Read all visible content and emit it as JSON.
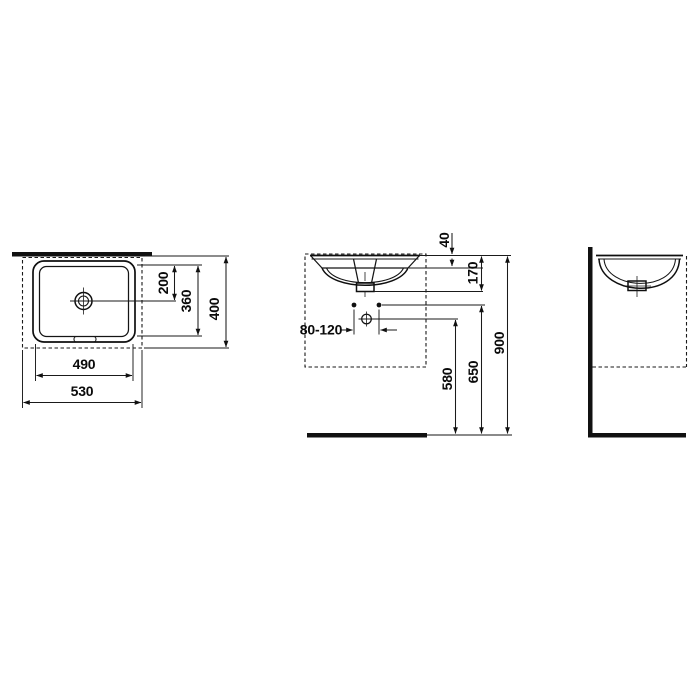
{
  "drawing": {
    "subject": "undermount-washbasin-installation-diagram",
    "line_color": "#1a1a1a",
    "background": "#ffffff"
  },
  "views": {
    "top": {
      "label": "top-view",
      "dims": {
        "d200": "200",
        "d360": "360",
        "d400": "400",
        "d490": "490",
        "d530": "530"
      }
    },
    "front": {
      "label": "front-view",
      "dims": {
        "d40": "40",
        "d170": "170",
        "d80_120": "80-120",
        "d580": "580",
        "d650": "650",
        "d900": "900"
      }
    },
    "side": {
      "label": "side-view"
    }
  }
}
